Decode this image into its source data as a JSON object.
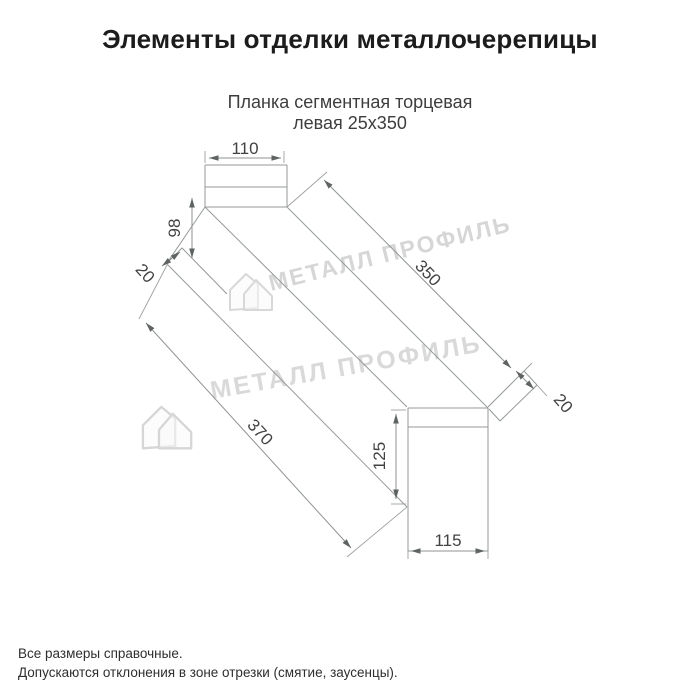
{
  "page": {
    "title": "Элементы отделки металлочерепицы"
  },
  "product": {
    "subtitle_line1": "Планка сегментная торцевая",
    "subtitle_line2": "левая 25х350"
  },
  "drawing": {
    "type": "isometric technical drawing of left segmental end strip 25x350",
    "dimensions": {
      "top_face_width": "110",
      "front_face_height": "98",
      "left_fold": "20",
      "length_outer": "370",
      "length_top": "350",
      "right_fold": "20",
      "back_face_height": "125",
      "back_face_width": "115"
    },
    "line_color": "#969a9a",
    "dim_text_color": "#424242",
    "watermark": {
      "brand": "МЕТАЛЛ ПРОФИЛЬ",
      "logo": "metall-profil-house-logo",
      "color": "#d0d0d0"
    }
  },
  "footer": {
    "note1": "Все размеры справочные.",
    "note2": "Допускаются отклонения в зоне отрезки (смятие, заусенцы)."
  }
}
